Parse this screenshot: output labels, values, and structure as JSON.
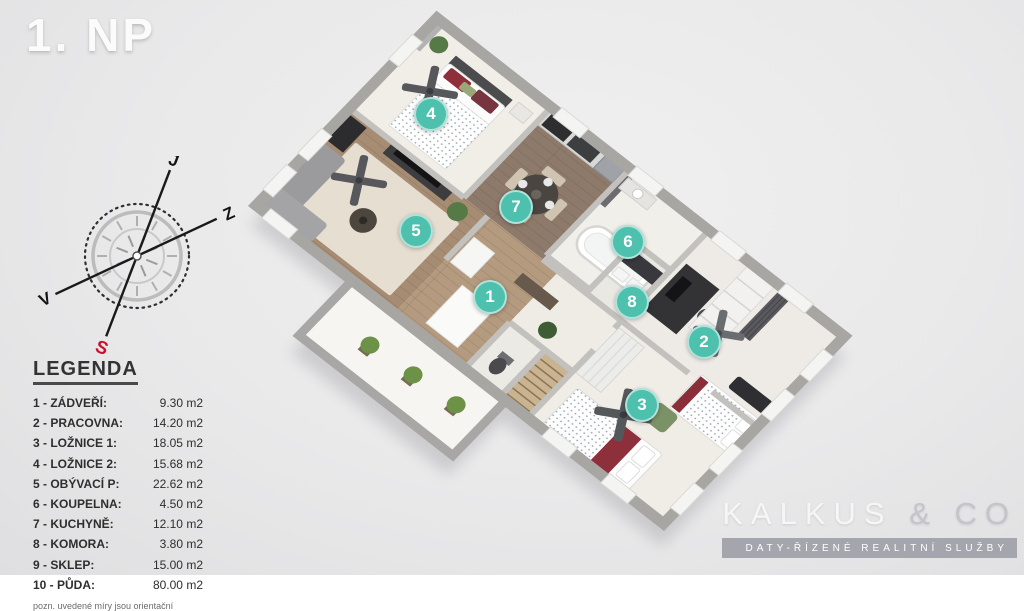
{
  "title": "1. NP",
  "legend": {
    "heading": "LEGENDA",
    "items": [
      {
        "label": "1 - ZÁDVEŘÍ:",
        "area": "9.30 m2"
      },
      {
        "label": "2 - PRACOVNA:",
        "area": "14.20 m2"
      },
      {
        "label": "3 - LOŽNICE 1:",
        "area": "18.05 m2"
      },
      {
        "label": "4 - LOŽNICE 2:",
        "area": "15.68 m2"
      },
      {
        "label": "5 - OBÝVACÍ P:",
        "area": "22.62 m2"
      },
      {
        "label": "6 - KOUPELNA:",
        "area": "4.50 m2"
      },
      {
        "label": "7 - KUCHYNĚ:",
        "area": "12.10 m2"
      },
      {
        "label": "8 - KOMORA:",
        "area": "3.80 m2"
      },
      {
        "label": "9 - SKLEP:",
        "area": "15.00 m2"
      },
      {
        "label": "10 - PŮDA:",
        "area": "80.00 m2"
      }
    ],
    "note": "pozn. uvedené míry jsou orientační"
  },
  "compass": {
    "south_label": "J",
    "west_label": "Z",
    "east_label": "V",
    "north_label": "S",
    "north_color": "#c8102e"
  },
  "floorplan": {
    "marker_color": "#4ec0ae",
    "markers": [
      {
        "label": "1",
        "x": 490,
        "y": 297
      },
      {
        "label": "2",
        "x": 704,
        "y": 342
      },
      {
        "label": "3",
        "x": 642,
        "y": 405
      },
      {
        "label": "4",
        "x": 431,
        "y": 114
      },
      {
        "label": "5",
        "x": 416,
        "y": 231
      },
      {
        "label": "6",
        "x": 628,
        "y": 242
      },
      {
        "label": "7",
        "x": 516,
        "y": 207
      },
      {
        "label": "8",
        "x": 632,
        "y": 302
      }
    ]
  },
  "logo": {
    "brand": "KALKUS",
    "separator": "&",
    "brand2": "CO",
    "tagline": "DATY-ŘÍZENÉ REALITNÍ SLUŽBY"
  }
}
